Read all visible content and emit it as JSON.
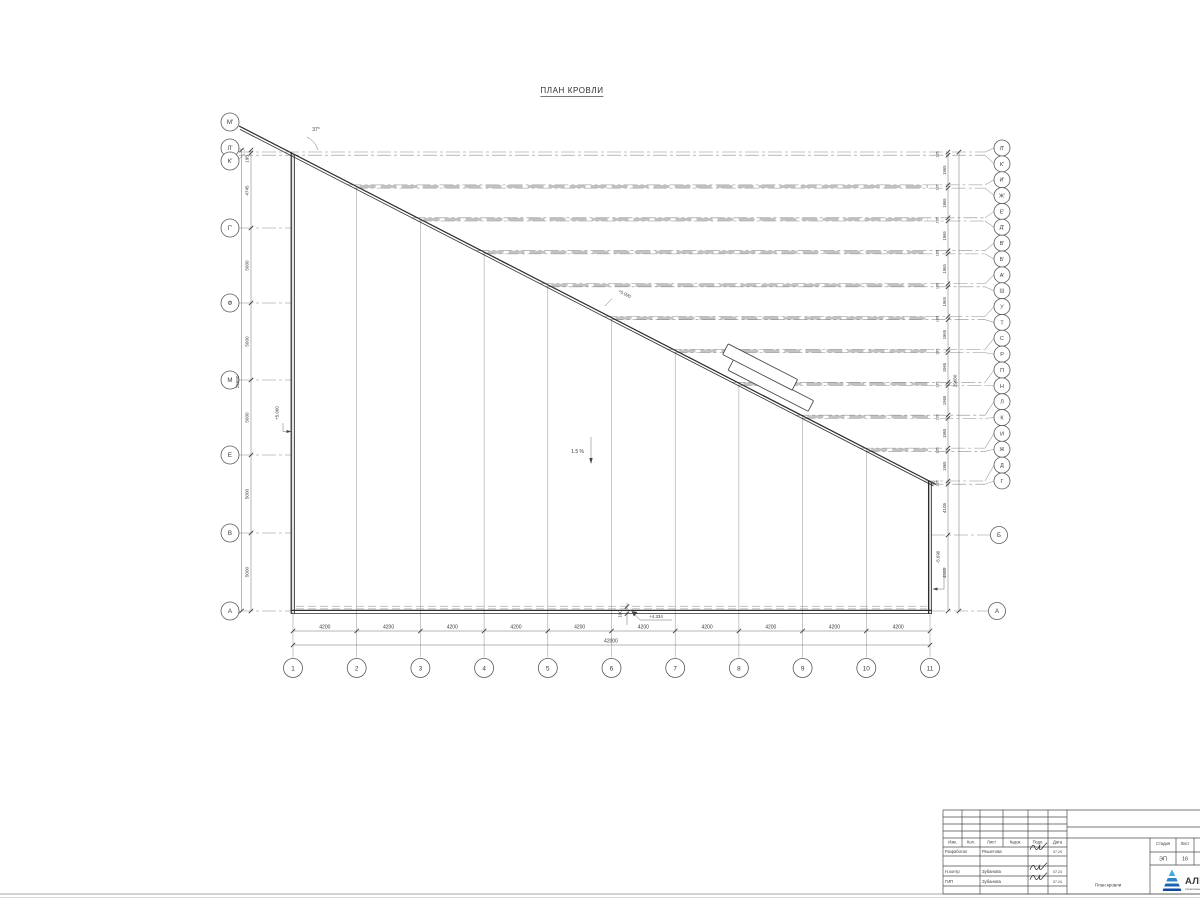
{
  "title": "ПЛАН КРОВЛИ",
  "plan": {
    "left_axes": [
      "М'",
      "Л'",
      "К'",
      "Г'",
      "Ф",
      "М",
      "Е",
      "В",
      "А"
    ],
    "right_axes": [
      "Л'",
      "К'",
      "И'",
      "Ж'",
      "Е'",
      "Д'",
      "В'",
      "Б'",
      "А'",
      "Ш",
      "У",
      "Т",
      "С",
      "Р",
      "П",
      "Н",
      "Л",
      "К",
      "И",
      "Ж",
      "Д",
      "Г"
    ],
    "right_lower_axes": [
      "Б",
      "А"
    ],
    "bottom_axes": [
      "1",
      "2",
      "3",
      "4",
      "5",
      "6",
      "7",
      "8",
      "9",
      "10",
      "11"
    ],
    "dims": {
      "bottom": [
        "4200",
        "4200",
        "4200",
        "4200",
        "4200",
        "4200",
        "4200",
        "4200",
        "4200",
        "4200"
      ],
      "bottom_total": "42000",
      "left": [
        "195",
        "4745",
        "5000",
        "5000",
        "5000",
        "5000",
        "5000"
      ],
      "left_total": "29680",
      "right_small": "195",
      "right_big": "1965",
      "right_lower": [
        "4105",
        "4500"
      ],
      "right_total": "29680",
      "parapet": "100"
    },
    "annotations": {
      "slope": "1.5 %",
      "angle": "37°",
      "elev_bottom": "+4.334",
      "elev_left": "+5.000",
      "elev_diag": "+5.090",
      "elev_right": "-5.690"
    }
  },
  "titleblock": {
    "header_cols": [
      "Изм.",
      "Кол.",
      "Лист",
      "№док.",
      "Подп.",
      "Дата"
    ],
    "rows": [
      {
        "role": "Разработал",
        "name": "Решетова",
        "date": "07.24"
      },
      {
        "role": "Н.контр",
        "name": "Зубанова",
        "date": "07.24"
      },
      {
        "role": "ГИП",
        "name": "Зубанова",
        "date": "07.24"
      }
    ],
    "doc_title": "План кровли",
    "stage_label": "Стадия",
    "sheet_label": "Лист",
    "stage": "ЭП",
    "sheet": "16",
    "logo": {
      "text": "АЛЬЯ",
      "subtext": "строительная компания",
      "color": "#0d3f91",
      "accent": "#2b85c8"
    }
  }
}
